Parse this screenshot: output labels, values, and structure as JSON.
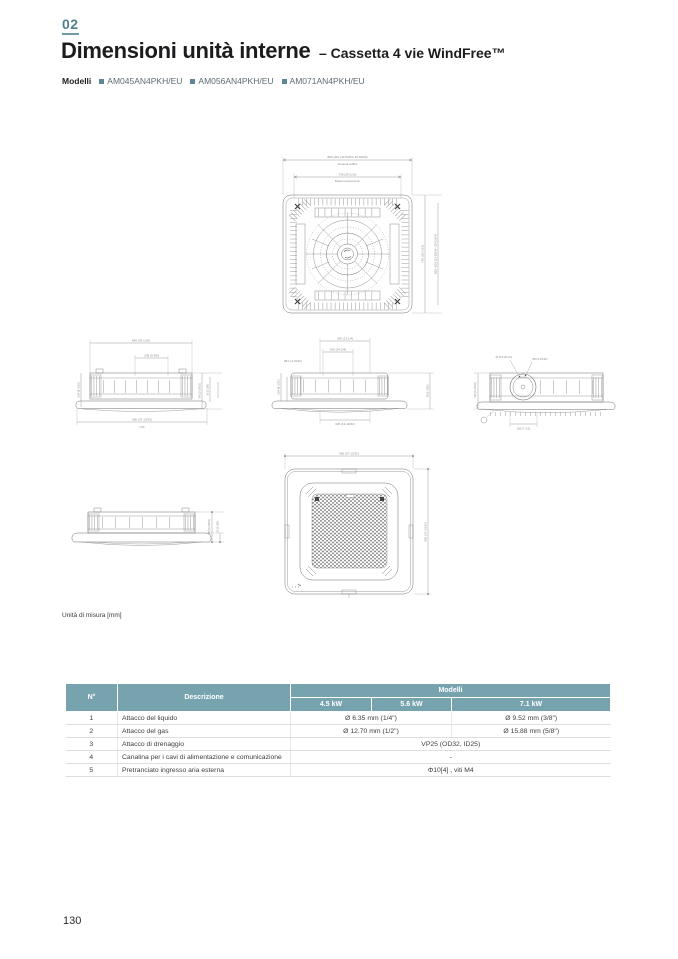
{
  "page": {
    "chapter": "02",
    "title": "Dimensioni unità interne",
    "subtitle": "– Cassetta 4 vie WindFree™",
    "models_label": "Modelli",
    "models": [
      "AM045AN4PKH/EU",
      "AM056AN4PKH/EU",
      "AM071AN4PKH/EU"
    ],
    "units_note": "Unità di misura [mm]",
    "page_number": "130"
  },
  "colors": {
    "accent_teal": "#76a3ae",
    "chapter_teal": "#507e8d",
    "model_square": "#5c8694",
    "title_text": "#1c1c1e",
    "body_text": "#3d3d3d",
    "drawing_line": "#6f6f6f",
    "table_border": "#dcdfe1"
  },
  "drawings": {
    "top_view": {
      "dim_a": "860~910 (33-55/64~35-53/64)",
      "dim_a_sub": "Foratura soffitto",
      "dim_b": "738 (29-1/16)",
      "dim_b_sub": "Bulloni sospensione",
      "dim_right_inner": "738 (29-1/16)",
      "dim_right_outer": "860~910 (33-55/64~35-53/64)"
    },
    "side_view_left": {
      "dim_top": "840 (33-1/16)",
      "dim_mid": "238 (9-3/8)",
      "dim_left": "204 (8-1/32)",
      "dim_right_a": "145 (5-23/32)",
      "dim_right_b": "35 (1-3/8)",
      "dim_bottom": "950 (37-13/32)",
      "dim_bottom_sub": "(13)"
    },
    "side_view_center": {
      "dim_top": "629 (24-3/4)",
      "dim_mid": "336 (13-1/4)",
      "dim_left_a": "88.1 (3-15/32)",
      "dim_left_b": "204 (8-1/32)",
      "dim_right": "26 (1-1/32)",
      "dim_bottom": "345 (13-19/32)"
    },
    "side_view_right": {
      "dim_top": "88 (3-15/32)",
      "dim_circle": "Ø 210 (8-1/4)",
      "dim_left": "145 (5-23/32)",
      "dim_bottom": "190 (7-1/2)"
    },
    "iso_view": {
      "dim_right_a": "145 (5-23/32)",
      "dim_right_b": "35 (1-3/8)"
    },
    "panel_view": {
      "dim_top": "950 (37-13/32)",
      "dim_right": "950 (37-13/32)"
    }
  },
  "table": {
    "col_no": "N°",
    "col_desc": "Descrizione",
    "col_models": "Modelli",
    "power_cols": [
      "4.5 kW",
      "5.6 kW",
      "7.1 kW"
    ],
    "rows": [
      {
        "no": "1",
        "desc": "Attacco del liquido",
        "val_45_56": "Ø 6.35 mm (1/4\")",
        "val_71": "Ø 9.52 mm (3/8\")"
      },
      {
        "no": "2",
        "desc": "Attacco del gas",
        "val_45_56": "Ø 12.70 mm (1/2\")",
        "val_71": "Ø 15.88 mm (5/8\")"
      },
      {
        "no": "3",
        "desc": "Attacco di drenaggio",
        "val_all": "VP25 (OD32, ID25)"
      },
      {
        "no": "4",
        "desc": "Canalina per i cavi di alimentazione e comunicazione",
        "val_all": "-"
      },
      {
        "no": "5",
        "desc": "Pretranciato ingresso aria esterna",
        "val_all": "Φ10[4] , viti M4"
      }
    ]
  }
}
